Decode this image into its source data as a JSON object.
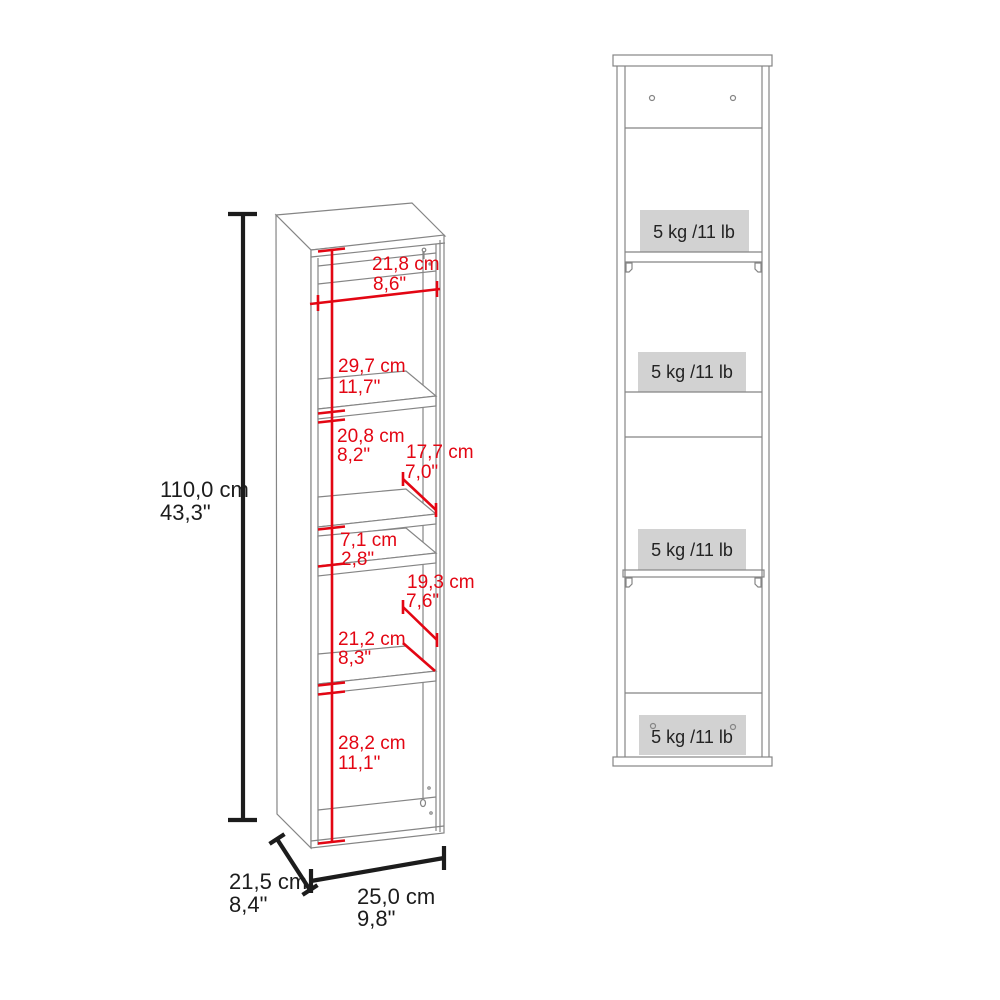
{
  "diagram": {
    "type": "furniture-dimension-drawing",
    "background": "#ffffff",
    "colors": {
      "dimension_red": "#e30613",
      "outline_gray": "#858585",
      "dimension_black": "#1c1c1c",
      "capacity_box_bg": "#d2d2d2"
    }
  },
  "perspective_view": {
    "overall": {
      "height_cm": "110,0 cm",
      "height_in": "43,3\"",
      "width_cm": "25,0 cm",
      "width_in": "9,8\"",
      "depth_cm": "21,5 cm",
      "depth_in": "8,4\""
    },
    "interior": {
      "inner_width_cm": "21,8 cm",
      "inner_width_in": "8,6\"",
      "section1_height_cm": "29,7 cm",
      "section1_height_in": "11,7\"",
      "section2_height_cm": "20,8 cm",
      "section2_height_in": "8,2\"",
      "upper_shelf_depth_cm": "17,7 cm",
      "upper_shelf_depth_in": "7,0\"",
      "niche_height_cm": "7,1 cm",
      "niche_height_in": "2,8\"",
      "lower_shelf_depth_cm": "19,3 cm",
      "lower_shelf_depth_in": "7,6\"",
      "section3_height_cm": "21,2 cm",
      "section3_height_in": "8,3\"",
      "section4_height_cm": "28,2 cm",
      "section4_height_in": "11,1\""
    }
  },
  "front_view": {
    "shelf_labels": [
      "5 kg /11 lb",
      "5 kg /11 lb",
      "5 kg /11 lb",
      "5 kg /11 lb"
    ]
  }
}
